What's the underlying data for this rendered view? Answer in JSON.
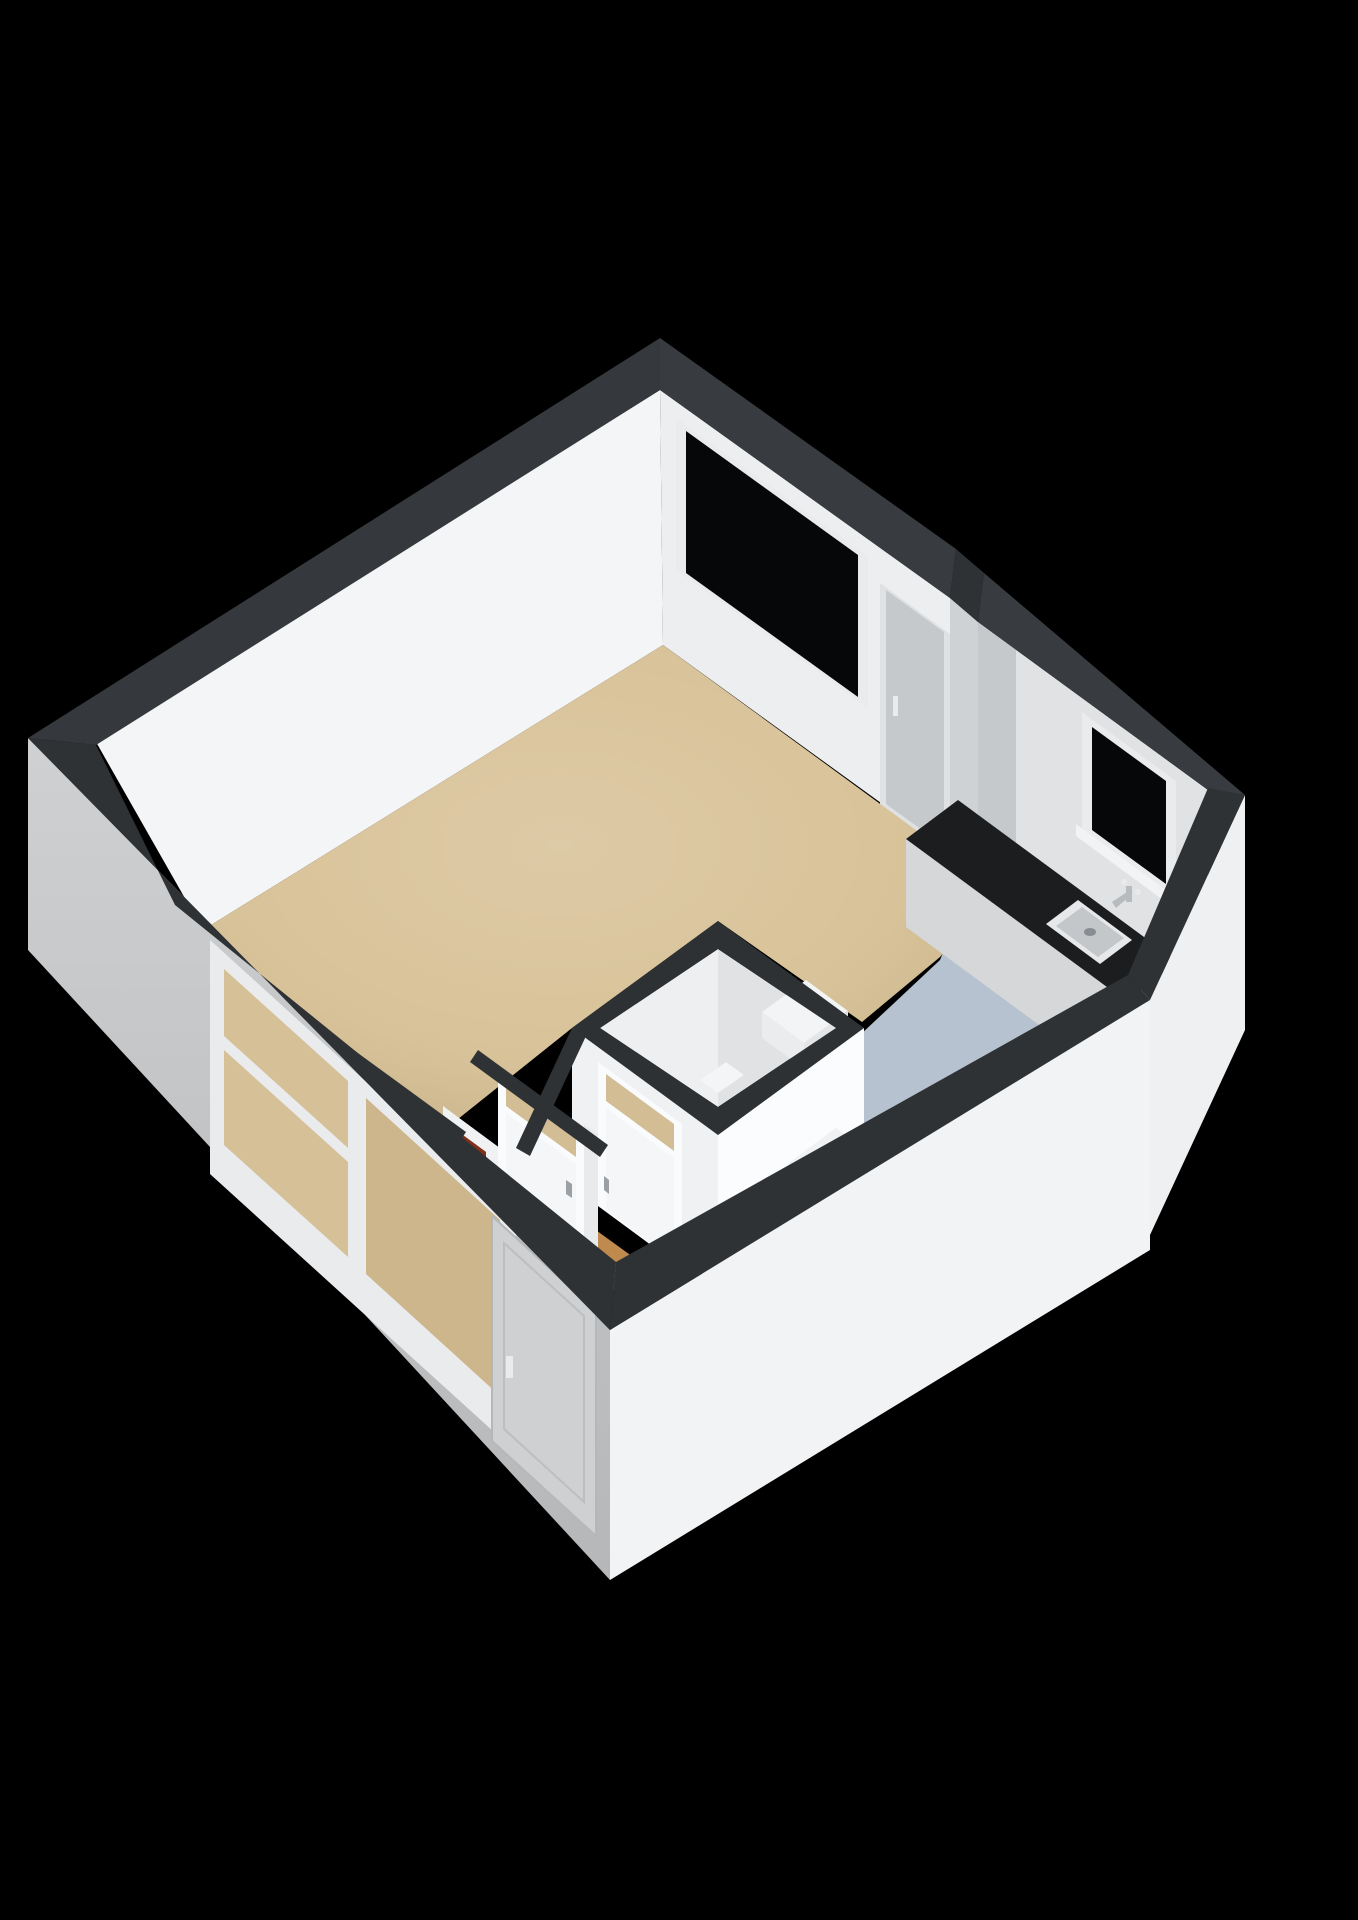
{
  "scene": {
    "type": "3d-floorplan-render",
    "view": "isometric-birdseye",
    "rooms": [
      {
        "name": "living-room",
        "floor": "beige"
      },
      {
        "name": "kitchen-zone",
        "floor": "blue-gray"
      },
      {
        "name": "bathroom-box",
        "floor": "white"
      },
      {
        "name": "hallway",
        "floor": "wood"
      }
    ],
    "features": [
      "large-window-ne-wall",
      "interior-door-ne-wall",
      "kitchen-counter-with-sink",
      "faucet",
      "small-window-above-sink",
      "bathroom-corner-shelf",
      "bathroom-door-with-transom",
      "hallway-door-with-transom",
      "meter-box-niche",
      "double-window-sw-wall",
      "exterior-entry-door",
      "steps-to-kitchen-zone"
    ]
  },
  "colors": {
    "background": "#000000",
    "wall_top": "#2f3235",
    "wall_top_light": "#383c40",
    "wall_top_nw": "#35383c",
    "wall_exterior_sw": "#c9cbcd",
    "wall_exterior_se": "#f2f3f4",
    "wall_exterior_bump": "#eef0f1",
    "wall_interior_nw": "#f4f5f6",
    "wall_interior_ne": "#eceef0",
    "wall_interior_kitchen": "#e0e2e4",
    "wall_jog_face": "#cfd2d5",
    "wall_shadow_strip": "#c6c9cc",
    "floor_main": "#d7c095",
    "floor_kitchen": "#b6c2cf",
    "floor_hallway": "#bf8a4e",
    "floor_hallway_dark": "#a9743c",
    "glass_dark": "#060708",
    "frame_white": "#e9ebed",
    "sill_white": "#f2f3f4",
    "door_shadow": "#c6c9cc",
    "door_frame_shadow": "#dfe1e3",
    "door_white": "#f5f6f7",
    "door_frame_white": "#fafbfc",
    "transom_glass": "#d3bd95",
    "counter_top": "#1b1d1f",
    "counter_front": "#d5d7d9",
    "counter_side": "#e1e3e5",
    "sink_rim": "#e6e8ea",
    "sink_basin": "#c3c7ca",
    "sink_drain": "#878d92",
    "faucet": "#b7bbbe",
    "faucet_light": "#e8eaec",
    "box_face_sw": "#f0f1f3",
    "box_face_se": "#fbfcfd",
    "box_interior": "#edeff0",
    "box_wall_top": "#2e3134",
    "shelf_top": "#f3f4f5",
    "shelf_front": "#e3e5e7",
    "shelf_side": "#eaecee",
    "toilet_white": "#f4f5f6",
    "step_top": "#eff1f2",
    "step_front": "#dadcde",
    "step_side": "#e8eaec",
    "niche_wall": "#eff1f2",
    "niche_side": "#e2e4e6",
    "meter_box": "#a8492a",
    "meter_box_dark": "#7e3118",
    "window_pane_left": "#d6c098",
    "window_pane_right": "#cdb68c",
    "entry_door": "#ced0d2",
    "handle_dark": "#9aa0a4",
    "handle_light": "#e9ebed",
    "wall_sliver": "#e8eaec"
  }
}
